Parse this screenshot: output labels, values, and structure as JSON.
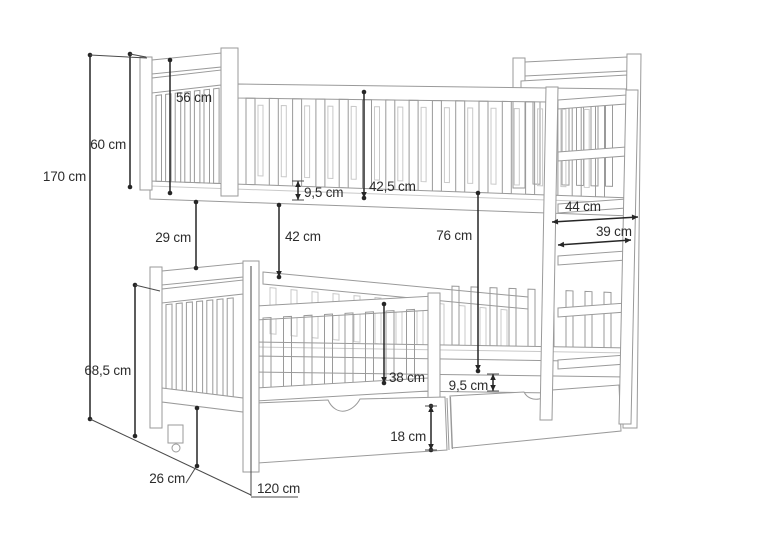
{
  "diagram": {
    "subject": "bunk bed technical drawing with ladder and storage drawers",
    "unit": "cm",
    "dimensions": [
      {
        "id": "total_height",
        "label": "170 cm",
        "value_cm": 170
      },
      {
        "id": "upper_section_height",
        "label": "60 cm",
        "value_cm": 60
      },
      {
        "id": "headboard_height",
        "label": "56 cm",
        "value_cm": 56
      },
      {
        "id": "upper_frame_thickness",
        "label": "9,5 cm",
        "value_cm": 9.5
      },
      {
        "id": "guard_top_to_frame",
        "label": "42,5 cm",
        "value_cm": 42.5
      },
      {
        "id": "left_end_gap",
        "label": "29 cm",
        "value_cm": 29
      },
      {
        "id": "frame_to_lower_rail",
        "label": "42 cm",
        "value_cm": 42
      },
      {
        "id": "upper_frame_to_mattress",
        "label": "76 cm",
        "value_cm": 76
      },
      {
        "id": "ladder_outer_width",
        "label": "44 cm",
        "value_cm": 44
      },
      {
        "id": "ladder_inner_width",
        "label": "39 cm",
        "value_cm": 39
      },
      {
        "id": "lower_section_height",
        "label": "68,5 cm",
        "value_cm": 68.5
      },
      {
        "id": "floor_clearance",
        "label": "26 cm",
        "value_cm": 26
      },
      {
        "id": "guard_rail_height",
        "label": "38 cm",
        "value_cm": 38
      },
      {
        "id": "lower_frame_thickness",
        "label": "9,5 cm",
        "value_cm": 9.5
      },
      {
        "id": "drawer_height",
        "label": "18 cm",
        "value_cm": 18
      },
      {
        "id": "bed_width",
        "label": "120 cm",
        "value_cm": 120
      }
    ],
    "colors": {
      "drawing_line": "#9a9a9a",
      "dimension_line": "#262626",
      "background": "#ffffff"
    }
  }
}
